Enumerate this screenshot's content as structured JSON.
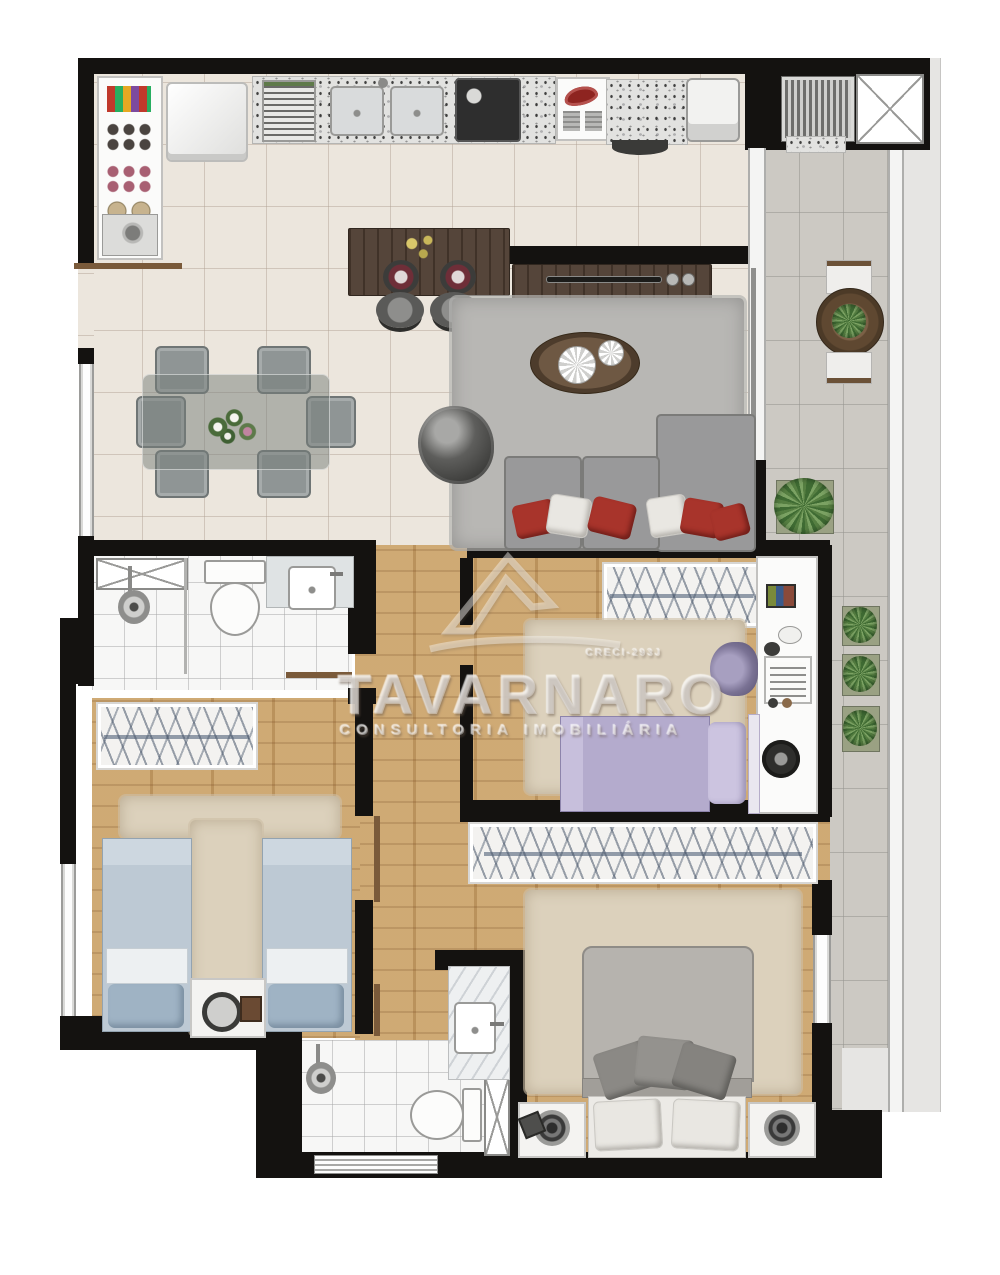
{
  "watermark": {
    "brand": "TAVARNARO",
    "subtitle": "CONSULTORIA IMOBILIÁRIA",
    "registration": "CRECI-293J"
  },
  "palette": {
    "wall": "#141210",
    "cream_tile": "#ece6dd",
    "wood_floor": "#c79e66",
    "balcony_tile": "#ccc9c3",
    "living_rug": "#b8b7b4",
    "beige_rug": "#dcd1bc",
    "sofa_gray": "#999997",
    "pillow_red": "#a8342b",
    "bed_blue": "#bdc9d4",
    "bed_lilac": "#b4abcd",
    "dark_wood": "#55453a"
  },
  "plan": {
    "type": "residential-apartment-floor-plan",
    "rooms": [
      {
        "name": "kitchen-laundry",
        "items": [
          "pantry-shelves",
          "refrigerator",
          "dish-rack",
          "double-sink",
          "cooktop",
          "iron-cabinet",
          "washer",
          "laundry-sink"
        ]
      },
      {
        "name": "living-dining",
        "items": [
          "dining-table-6-chairs",
          "bar-counter",
          "2-stools",
          "tv-panel",
          "media-rack",
          "shag-rug",
          "oval-coffee-table",
          "egg-armchair",
          "sectional-sofa"
        ]
      },
      {
        "name": "balcony",
        "items": [
          "barbecue-grill",
          "duct-shaft",
          "round-table",
          "2-chairs",
          "4-plants",
          "glass-railing"
        ]
      },
      {
        "name": "bathroom-social",
        "items": [
          "duct-shaft",
          "shower",
          "toilet",
          "vanity-sink"
        ]
      },
      {
        "name": "bedroom-twin",
        "items": [
          "wardrobe",
          "2-single-beds",
          "nightstand",
          "t-rug",
          "window"
        ]
      },
      {
        "name": "bedroom-single",
        "items": [
          "wardrobe",
          "single-bed",
          "desk",
          "chair",
          "steering-wheel",
          "rug"
        ]
      },
      {
        "name": "master-bedroom",
        "items": [
          "wardrobe",
          "double-bed",
          "2-nightstands",
          "rug",
          "window"
        ]
      },
      {
        "name": "bathroom-ensuite",
        "items": [
          "shower",
          "toilet",
          "marble-vanity",
          "duct-shaft",
          "window"
        ]
      }
    ]
  }
}
